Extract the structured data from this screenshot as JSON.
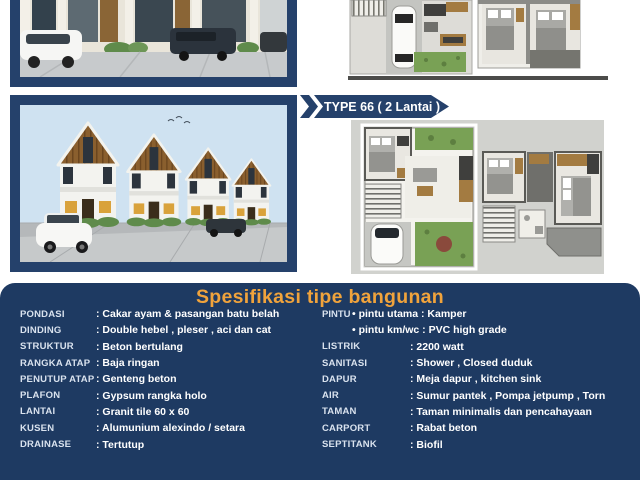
{
  "banner": {
    "label": "TYPE 66 ( 2 Lantai )"
  },
  "specs": {
    "heading": "Spesifikasi tipe bangunan",
    "left": [
      {
        "label": "PONDASI",
        "value": ": Cakar ayam & pasangan batu belah"
      },
      {
        "label": "DINDING",
        "value": ": Double hebel , pleser , aci dan cat"
      },
      {
        "label": "STRUKTUR",
        "value": ": Beton bertulang"
      },
      {
        "label": "RANGKA ATAP",
        "value": ": Baja ringan"
      },
      {
        "label": "PENUTUP ATAP",
        "value": ": Genteng beton"
      },
      {
        "label": "PLAFON",
        "value": ": Gypsum rangka holo"
      },
      {
        "label": "LANTAI",
        "value": ": Granit tile 60 x 60"
      },
      {
        "label": "KUSEN",
        "value": ": Alumunium alexindo / setara"
      },
      {
        "label": "DRAINASE",
        "value": ": Tertutup"
      }
    ],
    "pintu": {
      "label": "PINTU",
      "line1": "• pintu utama : Kamper",
      "line2": "• pintu km/wc : PVC high grade"
    },
    "right": [
      {
        "label": "LISTRIK",
        "value": ": 2200 watt"
      },
      {
        "label": "SANITASI",
        "value": ": Shower , Closed duduk"
      },
      {
        "label": "DAPUR",
        "value": ": Meja dapur , kitchen sink"
      },
      {
        "label": "AIR",
        "value": ": Sumur pantek , Pompa jetpump , Torn"
      },
      {
        "label": "TAMAN",
        "value": ": Taman minimalis dan pencahayaan"
      },
      {
        "label": "CARPORT",
        "value": ": Rabat beton"
      },
      {
        "label": "SEPTITANK",
        "value": ": Biofil"
      }
    ]
  },
  "colors": {
    "frame_navy": "#25416b",
    "panel_navy": "#1e3a62",
    "heading_orange": "#f0a33c",
    "label_light": "#d9e2ee",
    "value_white": "#ffffff",
    "plan_background_gray": "#d1d2ce",
    "sky_blue": "#cfe2f1",
    "garden_green": "#79a155",
    "wood_brown": "#8a5f2e"
  }
}
